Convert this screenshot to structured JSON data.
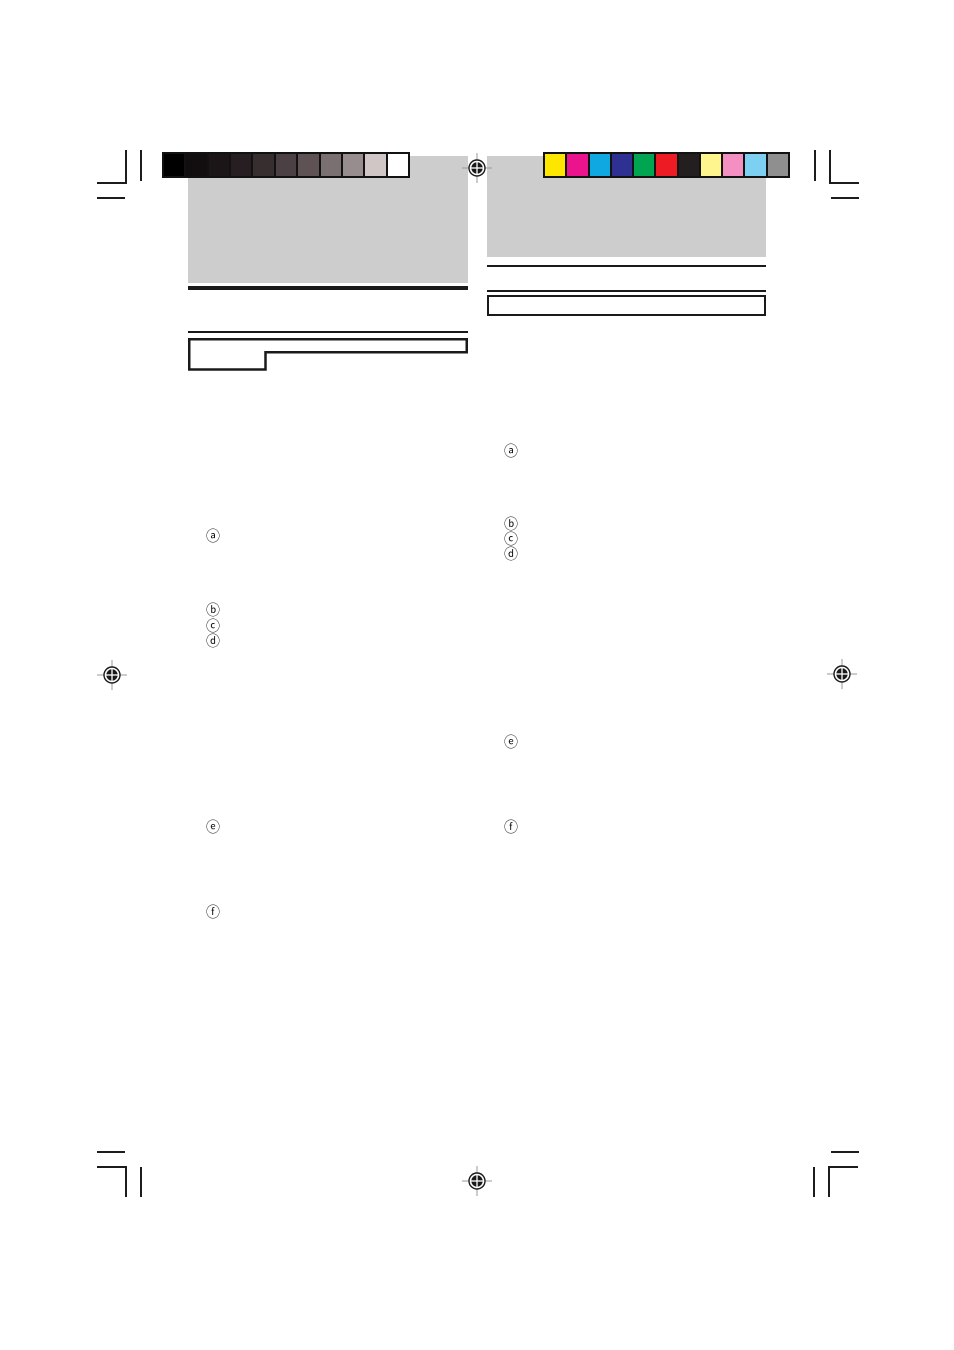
{
  "page": {
    "background": "#ffffff",
    "placeholder_gray": "#cdcdcd",
    "line_color": "#1a1a1a"
  },
  "grayscale_bar": {
    "description": "grayscale-calibration-strip",
    "swatches": [
      "#000000",
      "#120d0e",
      "#1c1517",
      "#261e20",
      "#372e30",
      "#4b4043",
      "#5e5254",
      "#7b7071",
      "#988d8e",
      "#cfc6c5",
      "#ffffff"
    ]
  },
  "color_bar": {
    "description": "color-calibration-strip",
    "swatches": [
      "#ffe600",
      "#ec148c",
      "#0fa8e0",
      "#2e3192",
      "#00a551",
      "#ed1c24",
      "#231f20",
      "#fff58f",
      "#f490c1",
      "#7dd0f2",
      "#8f8f8f"
    ]
  },
  "markers": {
    "left": {
      "a": "ⓐ",
      "b": "ⓑ",
      "c": "ⓒ",
      "d": "ⓓ",
      "e": "ⓔ",
      "f": "ⓕ"
    },
    "right": {
      "a": "ⓐ",
      "b": "ⓑ",
      "c": "ⓒ",
      "d": "ⓓ",
      "e": "ⓔ",
      "f": "ⓕ"
    }
  },
  "icons": {
    "registration_mark": "crosshair-target-circle",
    "crop_mark": "trim-corner-lines"
  }
}
